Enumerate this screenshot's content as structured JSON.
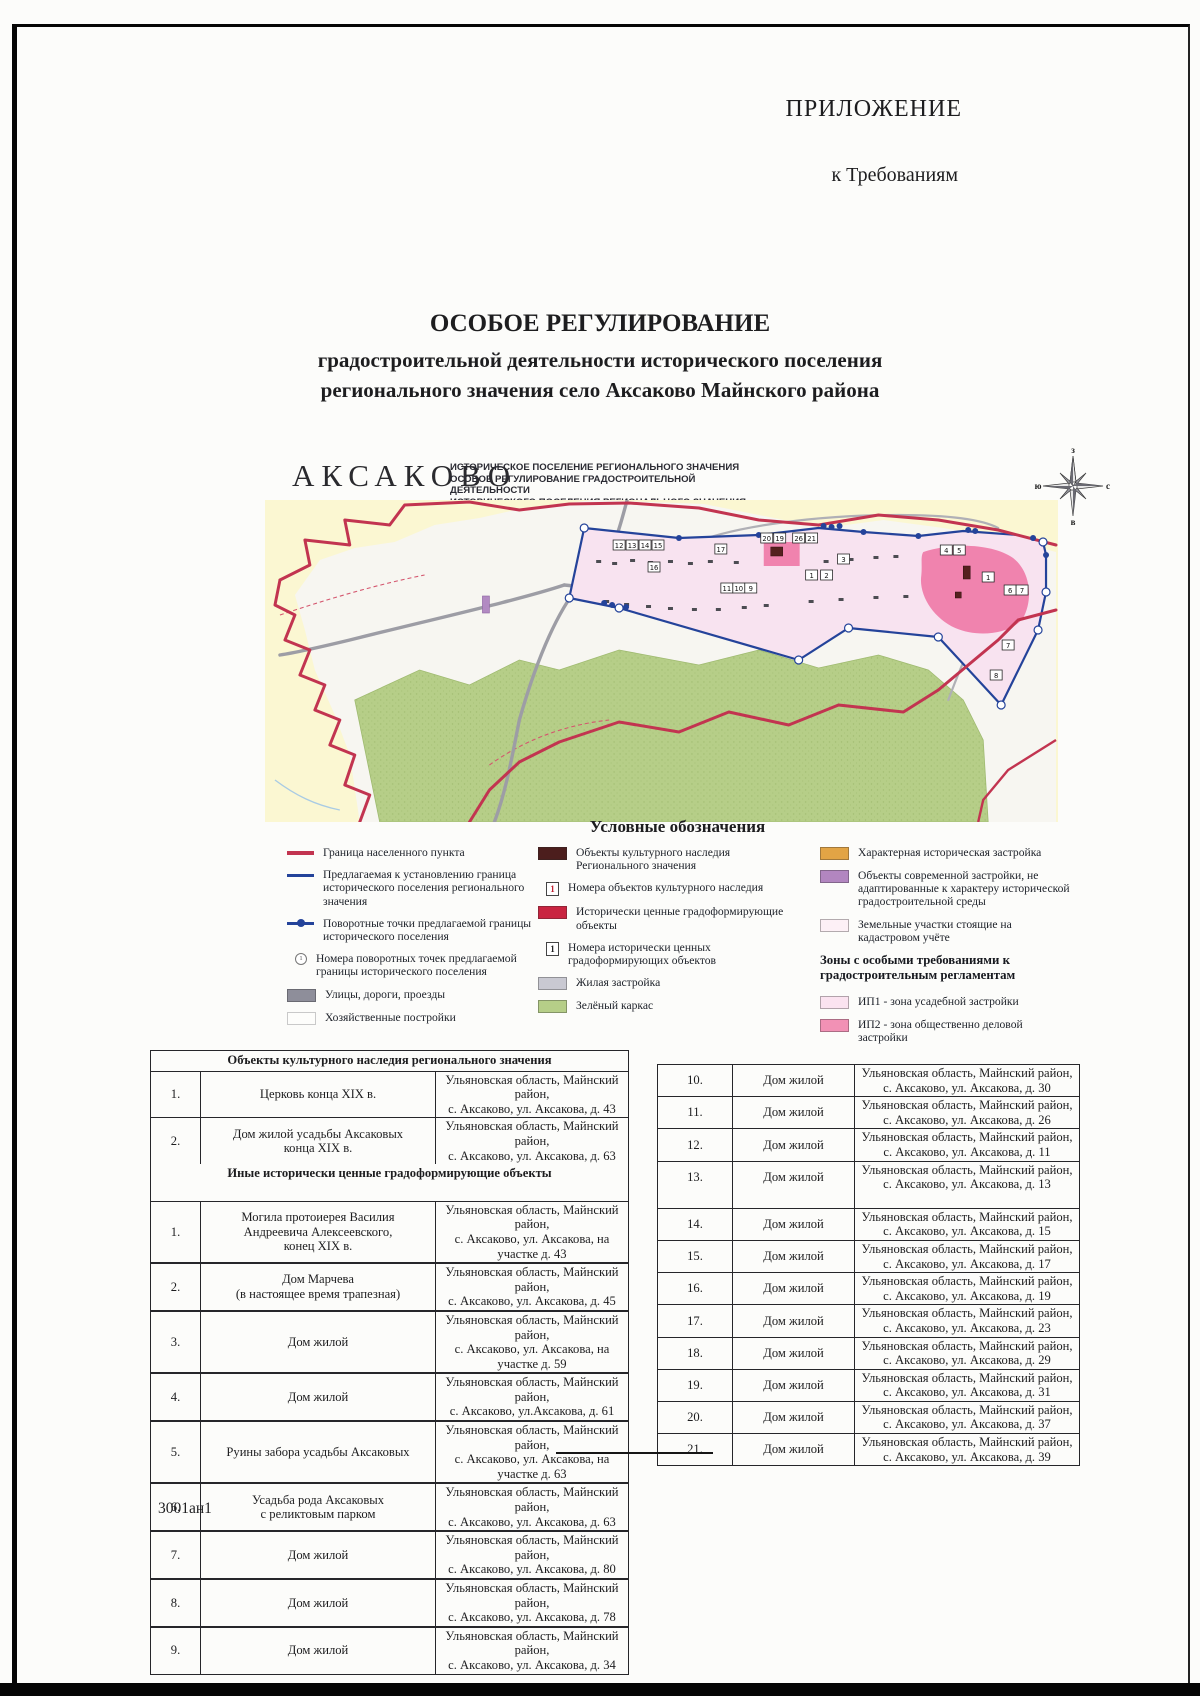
{
  "page": {
    "corner_label": "ПРИЛОЖЕНИЕ",
    "corner_sublabel": "к Требованиям",
    "title_line1": "ОСОБОЕ РЕГУЛИРОВАНИЕ",
    "title_line2": "градостроительной деятельности исторического поселения",
    "title_line3": "регионального значения село Аксаково Майнского района",
    "footer_code": "3001ан1"
  },
  "map": {
    "name": "АКСАКОВО",
    "subtitle_line1": "ИСТОРИЧЕСКОЕ ПОСЕЛЕНИЕ РЕГИОНАЛЬНОГО ЗНАЧЕНИЯ",
    "subtitle_line2": "ОСОБОЕ РЕГУЛИРОВАНИЕ ГРАДОСТРОИТЕЛЬНОЙ ДЕЯТЕЛЬНОСТИ",
    "subtitle_line3": "ИСТОРИЧЕСКОГО ПОСЕЛЕНИЯ РЕГИОНАЛЬНОГО ЗНАЧЕНИЯ СЕЛО АКСАКОВО",
    "compass": {
      "top": "з",
      "left": "ю",
      "right": "с",
      "bottom": "в"
    },
    "plot_numbers": [
      "12",
      "13",
      "14",
      "15",
      "16",
      "17",
      "20",
      "19",
      "26",
      "21",
      "11",
      "10",
      "9",
      "1",
      "2",
      "3",
      "4",
      "5",
      "1",
      "6",
      "7",
      "7",
      "8"
    ],
    "colors": {
      "settlement_boundary": "#c23450",
      "historic_boundary": "#24439a",
      "zone_ip1": "#f8e3f0",
      "zone_ip2": "#f083ae",
      "green_frame": "#b6ce88",
      "field": "#fbf7d2",
      "roads": "#9d9da5"
    }
  },
  "legend": {
    "title": "Условные обозначения",
    "col1": [
      {
        "label": "Граница населенного пункта",
        "swatch": "line-red"
      },
      {
        "label": "Предлагаемая к установлению граница исторического поселения регионального значения",
        "swatch": "line-blue"
      },
      {
        "label": "Поворотные точки предлагаемой границы исторического поселения",
        "swatch": "line-blue-dot"
      },
      {
        "label": "Номера поворотных точек предлагаемой границы исторического поселения",
        "swatch": "point-number",
        "symbol": "1"
      },
      {
        "label": "Улицы, дороги, проезды",
        "swatch": "box",
        "color": "#8e8e9a"
      },
      {
        "label": "Хозяйственные постройки",
        "swatch": "box-outline"
      }
    ],
    "col2": [
      {
        "label": "Объекты культурного наследия Регионального значения",
        "swatch": "box",
        "color": "#4c1e1d"
      },
      {
        "label": "Номера объектов культурного наследия",
        "swatch": "num-box",
        "symbol": "1",
        "symbol_color": "#c02030"
      },
      {
        "label": "Исторически ценные градоформирующие объекты",
        "swatch": "box",
        "color": "#c92440"
      },
      {
        "label": "Номера исторически ценных градоформирующих объектов",
        "swatch": "num-box",
        "symbol": "1",
        "symbol_color": "#222222"
      },
      {
        "label": "Жилая застройка",
        "swatch": "box",
        "color": "#c9c9d2"
      },
      {
        "label": "Зелёный каркас",
        "swatch": "box",
        "color": "#b6ce88"
      }
    ],
    "col3": {
      "items": [
        {
          "label": "Характерная историческая застройка",
          "swatch": "box",
          "color": "#e2a445"
        },
        {
          "label": "Объекты современной застройки, не адаптированные к характеру исторической градостроительной среды",
          "swatch": "box",
          "color": "#b286c0"
        },
        {
          "label": "Земельные участки стоящие на кадастровом учёте",
          "swatch": "box",
          "color": "#fdf0f6"
        }
      ],
      "zones_heading": "Зоны с особыми требованиями к градостроительным регламентам",
      "zones": [
        {
          "label": "ИП1 - зона усадебной застройки",
          "swatch": "box",
          "color": "#fbe3f0"
        },
        {
          "label": "ИП2 - зона общественно деловой застройки",
          "swatch": "box",
          "color": "#f291b5"
        }
      ]
    }
  },
  "tables": {
    "left": {
      "section1_title": "Объекты культурного наследия регионального значения",
      "rows1": [
        {
          "num": "1.",
          "name": "Церковь конца XIX в.",
          "addr1": "Ульяновская область, Майнский район,",
          "addr2": "с. Аксаково, ул. Аксакова, д. 43"
        },
        {
          "num": "2.",
          "name": "Дом жилой усадьбы Аксаковых\nконца XIX в.",
          "addr1": "Ульяновская область, Майнский район,",
          "addr2": "с. Аксаково, ул. Аксакова, д. 63"
        }
      ],
      "section2_title": "Иные исторически ценные градоформирующие объекты",
      "rows2": [
        {
          "num": "1.",
          "name": "Могила протоиерея Василия\nАндреевича Алексеевского,\nконец XIX в.",
          "addr1": "Ульяновская область, Майнский район,",
          "addr2": "с. Аксаково, ул. Аксакова, на участке д. 43"
        },
        {
          "num": "2.",
          "name": "Дом Марчева\n(в настоящее время трапезная)",
          "addr1": "Ульяновская область, Майнский район,",
          "addr2": "с. Аксаково, ул. Аксакова, д. 45"
        },
        {
          "num": "3.",
          "name": "Дом жилой",
          "addr1": "Ульяновская область, Майнский район,",
          "addr2": "с. Аксаково, ул. Аксакова, на участке д. 59"
        },
        {
          "num": "4.",
          "name": "Дом жилой",
          "addr1": "Ульяновская область, Майнский район,",
          "addr2": "с. Аксаково, ул.Аксакова, д. 61"
        },
        {
          "num": "5.",
          "name": "Руины забора усадьбы Аксаковых",
          "addr1": "Ульяновская область, Майнский район,",
          "addr2": "с. Аксаково, ул. Аксакова, на участке д. 63"
        },
        {
          "num": "6.",
          "name": "Усадьба рода Аксаковых\nс реликтовым парком",
          "addr1": "Ульяновская область, Майнский район,",
          "addr2": "с. Аксаково, ул. Аксакова, д. 63"
        },
        {
          "num": "7.",
          "name": "Дом жилой",
          "addr1": "Ульяновская область, Майнский район,",
          "addr2": "с. Аксаково, ул. Аксакова, д. 80"
        },
        {
          "num": "8.",
          "name": "Дом жилой",
          "addr1": "Ульяновская область, Майнский район,",
          "addr2": "с. Аксаково, ул. Аксакова, д. 78"
        },
        {
          "num": "9.",
          "name": "Дом жилой",
          "addr1": "Ульяновская область, Майнский район,",
          "addr2": "с. Аксаково, ул. Аксакова, д. 34"
        }
      ]
    },
    "right": {
      "rows": [
        {
          "num": "10.",
          "name": "Дом жилой",
          "addr1": "Ульяновская область, Майнский район,",
          "addr2": "с. Аксаково, ул. Аксакова, д. 30"
        },
        {
          "num": "11.",
          "name": "Дом жилой",
          "addr1": "Ульяновская область, Майнский район,",
          "addr2": "с. Аксаково, ул. Аксакова, д. 26"
        },
        {
          "num": "12.",
          "name": "Дом жилой",
          "addr1": "Ульяновская область, Майнский район,",
          "addr2": "с. Аксаково, ул. Аксакова, д. 11"
        },
        {
          "num": "13.",
          "name": "Дом жилой",
          "addr1": "Ульяновская область, Майнский район,",
          "addr2": "с. Аксаково, ул. Аксакова, д. 13",
          "row_class": "tall"
        },
        {
          "num": "14.",
          "name": "Дом жилой",
          "addr1": "Ульяновская область, Майнский район,",
          "addr2": "с. Аксаково, ул. Аксакова, д. 15"
        },
        {
          "num": "15.",
          "name": "Дом жилой",
          "addr1": "Ульяновская область, Майнский район,",
          "addr2": "с. Аксаково, ул. Аксакова, д. 17"
        },
        {
          "num": "16.",
          "name": "Дом жилой",
          "addr1": "Ульяновская область, Майнский район,",
          "addr2": "с. Аксаково, ул. Аксакова, д. 19"
        },
        {
          "num": "17.",
          "name": "Дом жилой",
          "addr1": "Ульяновская область, Майнский район,",
          "addr2": "с. Аксаково, ул. Аксакова, д. 23"
        },
        {
          "num": "18.",
          "name": "Дом жилой",
          "addr1": "Ульяновская область, Майнский район,",
          "addr2": "с. Аксаково, ул. Аксакова, д. 29"
        },
        {
          "num": "19.",
          "name": "Дом жилой",
          "addr1": "Ульяновская область, Майнский район,",
          "addr2": "с. Аксаково, ул. Аксакова, д. 31"
        },
        {
          "num": "20.",
          "name": "Дом жилой",
          "addr1": "Ульяновская область, Майнский район,",
          "addr2": "с. Аксаково, ул. Аксакова, д. 37"
        },
        {
          "num": "21.",
          "name": "Дом жилой",
          "addr1": "Ульяновская область, Майнский район,",
          "addr2": "с. Аксаково, ул. Аксакова, д. 39"
        }
      ]
    }
  }
}
